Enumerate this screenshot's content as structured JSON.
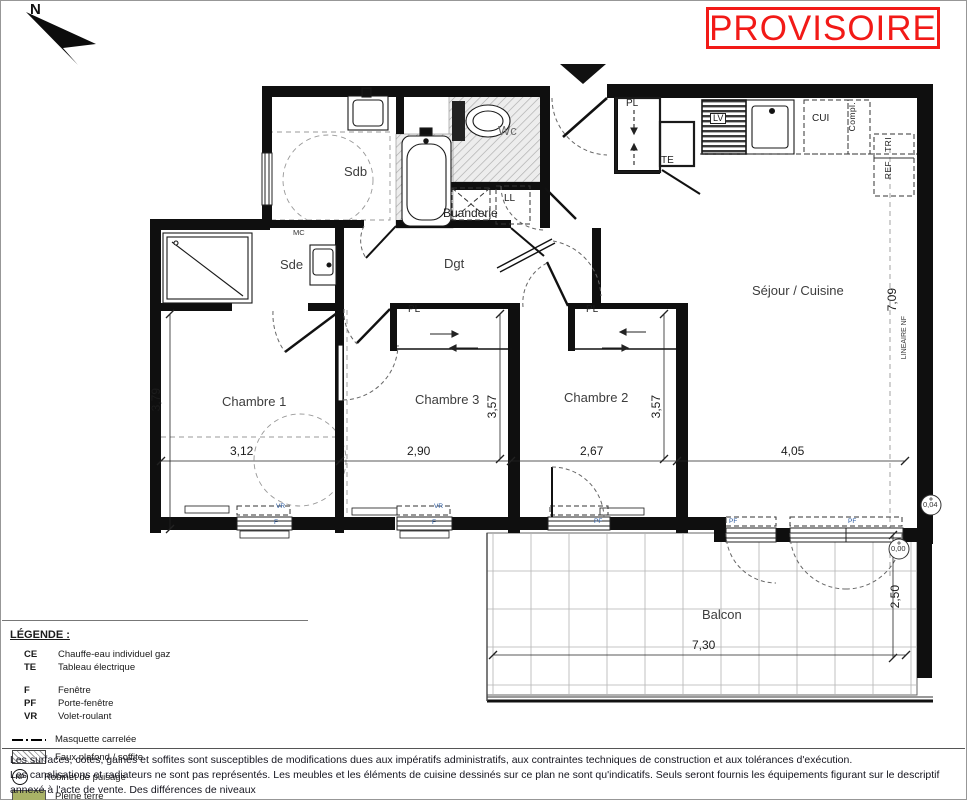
{
  "stamp": {
    "text": "PROVISOIRE",
    "color": "#f21a17"
  },
  "north": {
    "label": "N"
  },
  "plan": {
    "labels": [
      {
        "id": "room-sdb",
        "text": "Sdb",
        "x": 344,
        "y": 165,
        "cls": "room"
      },
      {
        "id": "room-wc",
        "text": "Wc",
        "x": 498,
        "y": 124,
        "cls": "room muted"
      },
      {
        "id": "room-buanderie",
        "text": "Buanderie",
        "x": 443,
        "y": 207,
        "cls": "room-sm"
      },
      {
        "id": "code-ll",
        "text": "LL",
        "x": 504,
        "y": 194,
        "cls": "code"
      },
      {
        "id": "room-sde",
        "text": "Sde",
        "x": 280,
        "y": 258,
        "cls": "room"
      },
      {
        "id": "code-mc",
        "text": "MC",
        "x": 293,
        "y": 229,
        "cls": "tiny"
      },
      {
        "id": "room-dgt",
        "text": "Dgt",
        "x": 444,
        "y": 257,
        "cls": "room"
      },
      {
        "id": "code-pl-entree",
        "text": "PL",
        "x": 626,
        "y": 99,
        "cls": "code"
      },
      {
        "id": "code-te",
        "text": "TE",
        "x": 661,
        "y": 156,
        "cls": "code"
      },
      {
        "id": "code-lv",
        "text": "LV",
        "x": 710,
        "y": 113,
        "cls": "code chip"
      },
      {
        "id": "code-cui",
        "text": "CUI",
        "x": 812,
        "y": 114,
        "cls": "code"
      },
      {
        "id": "code-compl",
        "text": "Compl.",
        "x": 848,
        "y": 102,
        "cls": "codev"
      },
      {
        "id": "code-tri",
        "text": "TRI",
        "x": 884,
        "y": 137,
        "cls": "codev"
      },
      {
        "id": "code-ref",
        "text": "REF",
        "x": 884,
        "y": 161,
        "cls": "codev"
      },
      {
        "id": "room-chambre1",
        "text": "Chambre 1",
        "x": 222,
        "y": 395,
        "cls": "room"
      },
      {
        "id": "room-chambre3",
        "text": "Chambre 3",
        "x": 415,
        "y": 393,
        "cls": "room"
      },
      {
        "id": "room-chambre2",
        "text": "Chambre 2",
        "x": 564,
        "y": 391,
        "cls": "room"
      },
      {
        "id": "room-sejour",
        "text": "Séjour / Cuisine",
        "x": 752,
        "y": 284,
        "cls": "room"
      },
      {
        "id": "room-balcon",
        "text": "Balcon",
        "x": 702,
        "y": 608,
        "cls": "room"
      },
      {
        "id": "code-pl-ch3",
        "text": "PL",
        "x": 408,
        "y": 305,
        "cls": "code"
      },
      {
        "id": "code-pl-ch2",
        "text": "PL",
        "x": 586,
        "y": 305,
        "cls": "code"
      },
      {
        "id": "dim-3-79",
        "text": "3,79",
        "x": 150,
        "y": 388,
        "cls": "dimv"
      },
      {
        "id": "dim-3-12",
        "text": "3,12",
        "x": 230,
        "y": 445,
        "cls": "dim"
      },
      {
        "id": "dim-2-90",
        "text": "2,90",
        "x": 407,
        "y": 445,
        "cls": "dim"
      },
      {
        "id": "dim-3-57-a",
        "text": "3,57",
        "x": 486,
        "y": 395,
        "cls": "dimv"
      },
      {
        "id": "dim-2-67",
        "text": "2,67",
        "x": 580,
        "y": 445,
        "cls": "dim"
      },
      {
        "id": "dim-3-57-b",
        "text": "3,57",
        "x": 650,
        "y": 395,
        "cls": "dimv"
      },
      {
        "id": "dim-4-05",
        "text": "4,05",
        "x": 781,
        "y": 445,
        "cls": "dim"
      },
      {
        "id": "dim-7-09",
        "text": "7,09",
        "x": 886,
        "y": 288,
        "cls": "dimv"
      },
      {
        "id": "dim-lineaire-nf",
        "text": "LINEAIRE NF",
        "x": 901,
        "y": 316,
        "cls": "tinyv"
      },
      {
        "id": "dim-2-50",
        "text": "2,50",
        "x": 889,
        "y": 585,
        "cls": "dimv"
      },
      {
        "id": "dim-7-30",
        "text": "7,30",
        "x": 692,
        "y": 639,
        "cls": "dim"
      },
      {
        "id": "level-interieur",
        "text": "0,04",
        "x": 923,
        "y": 501,
        "cls": "tiny"
      },
      {
        "id": "level-balcon",
        "text": "0,00",
        "x": 891,
        "y": 545,
        "cls": "tiny"
      },
      {
        "id": "win-vr-ch1",
        "text": "VR",
        "x": 276,
        "y": 504,
        "cls": "tiny6"
      },
      {
        "id": "win-f-ch1",
        "text": "F",
        "x": 274,
        "y": 520,
        "cls": "tiny6"
      },
      {
        "id": "win-vr-ch3",
        "text": "VR",
        "x": 434,
        "y": 504,
        "cls": "tiny6"
      },
      {
        "id": "win-f-ch3",
        "text": "F",
        "x": 432,
        "y": 520,
        "cls": "tiny6"
      },
      {
        "id": "win-pf-ch2",
        "text": "PF",
        "x": 594,
        "y": 519,
        "cls": "tiny6"
      },
      {
        "id": "win-pf-sejour-1",
        "text": "PF",
        "x": 729,
        "y": 519,
        "cls": "tiny6"
      },
      {
        "id": "win-pf-sejour-2",
        "text": "PF",
        "x": 848,
        "y": 519,
        "cls": "tiny6"
      }
    ]
  },
  "legend": {
    "title": "LÉGENDE :",
    "abbreviations": [
      {
        "code": "CE",
        "label": "Chauffe-eau individuel gaz"
      },
      {
        "code": "TE",
        "label": "Tableau électrique"
      },
      {
        "code": "F",
        "label": "Fenêtre",
        "gap": true
      },
      {
        "code": "PF",
        "label": "Porte-fenêtre"
      },
      {
        "code": "VR",
        "label": "Volet-roulant"
      }
    ],
    "symbols": [
      {
        "type": "dash",
        "label": "Masquette carrelée"
      },
      {
        "type": "hatch",
        "label": "Faux plafond / soffite"
      },
      {
        "type": "rp",
        "badge": "RP",
        "label": "Robinet de puisage"
      },
      {
        "type": "swatch",
        "color": "#a9b266",
        "label": "Pleine terre"
      },
      {
        "type": "swatch",
        "color": "#d8df96",
        "label": "Dalle plantée"
      }
    ]
  },
  "disclaimer": {
    "lines": [
      "Les surfaces, cotes, gaines et soffites sont susceptibles de modifications dues aux impératifs administratifs, aux contraintes techniques de construction et aux tolérances d'exécution.",
      "Les canalisations et radiateurs ne sont pas représentés. Les meubles et les éléments de cuisine dessinés sur ce plan ne sont qu'indicatifs. Seuls seront fournis les équipements figurant sur le descriptif annexé à l'acte de vente. Des différences de niveaux",
      "altimétriques peuvent être observées entre les terrasses et les jardins"
    ]
  }
}
